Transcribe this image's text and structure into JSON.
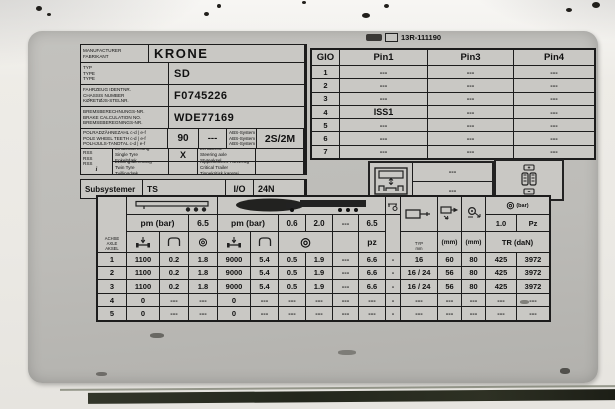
{
  "icons": {
    "brake_drum": "◎"
  },
  "plate": {
    "approval_number": "13R-111190",
    "info": {
      "manufacturer": {
        "labels": [
          "MANUFACTURER",
          "FABRIKANT"
        ],
        "value": "KRONE"
      },
      "type": {
        "labels": [
          "TYP",
          "TYPE",
          "TYPE"
        ],
        "value": "SD"
      },
      "chassis": {
        "labels": [
          "FAHRZEUG IDENTNR.",
          "CHASSIS NUMBER",
          "KØRETØJS-STELNR."
        ],
        "value": "F0745226"
      },
      "brake_calc": {
        "labels": [
          "BREMSBERECHNUNGS-NR.",
          "BRAKE CALCULATION NO.",
          "BREMSEBEREGNINGS-NR."
        ],
        "value": "WDE77169"
      },
      "pole_wheel": {
        "labels": [
          "POLRADZÄHNEZAHL c-d | e-f",
          "POLE WHEEL TEETH c-d | e-f",
          "POLHJULS-TANDTAL c-d | e-f"
        ],
        "teeth": "90",
        "teeth2": "---",
        "abs": [
          "ABS-System",
          "ABS-System",
          "ABS-System"
        ],
        "system": "2S/2M"
      },
      "rss": {
        "marks": [
          "RSS",
          "RSS",
          "RSS"
        ],
        "info_mark": "i",
        "single_tyre": {
          "labels": [
            "Einfachbereifung",
            "Single Tyre",
            "Enkeltdæk"
          ],
          "value": "X"
        },
        "steering_axle": {
          "labels": [
            "Lenkachse",
            "Steering axle",
            "Styreaksel"
          ],
          "value": ""
        },
        "twin_tyre": {
          "labels": [
            "Zwillingsbereifung",
            "Twin Tyre",
            "Tvillingdæk"
          ],
          "value": ""
        },
        "critical_trailer": {
          "labels": [
            "Kippkritisches Fahrzeug",
            "Critical Trailer",
            "Tippekritisk køretøj"
          ],
          "value": ""
        }
      },
      "subsystem": {
        "label": "Subsystemer",
        "value": "TS",
        "io_label": "I/O",
        "io_value": "24N"
      }
    },
    "gio": {
      "headers": [
        "GIO",
        "Pin1",
        "Pin3",
        "Pin4"
      ],
      "rows": [
        [
          "1",
          "---",
          "---",
          "---"
        ],
        [
          "2",
          "---",
          "---",
          "---"
        ],
        [
          "3",
          "---",
          "---",
          "---"
        ],
        [
          "4",
          "ISS1",
          "---",
          "---"
        ],
        [
          "5",
          "---",
          "---",
          "---"
        ],
        [
          "6",
          "---",
          "---",
          "---"
        ],
        [
          "7",
          "---",
          "---",
          "---"
        ]
      ]
    },
    "aux": {
      "values": [
        "---",
        "---"
      ]
    },
    "brake_table": {
      "axle_header": [
        "ACHSE",
        "AXLE",
        "AKSEL"
      ],
      "unladen": {
        "pm_label": "pm (bar)",
        "limit": "6.5"
      },
      "laden": {
        "pm_label": "pm (bar)",
        "p1": "0.6",
        "p2": "2.0",
        "p3": "---",
        "p4": "6.5",
        "pz": "pz"
      },
      "cylinder": {
        "typ": [
          "TYP",
          "mm"
        ],
        "mm1": "(mm)",
        "mm2": "(mm)"
      },
      "retention": {
        "bar_label": "(bar)",
        "p": "1.0",
        "pz": "Pz",
        "tr": "TR (daN)"
      },
      "rows": [
        [
          "1",
          "1100",
          "0.2",
          "1.8",
          "9000",
          "5.4",
          "0.5",
          "1.9",
          "---",
          "6.6",
          "-",
          "16",
          "60",
          "80",
          "425",
          "3972"
        ],
        [
          "2",
          "1100",
          "0.2",
          "1.8",
          "9000",
          "5.4",
          "0.5",
          "1.9",
          "---",
          "6.6",
          "-",
          "16 / 24",
          "56",
          "80",
          "425",
          "3972"
        ],
        [
          "3",
          "1100",
          "0.2",
          "1.8",
          "9000",
          "5.4",
          "0.5",
          "1.9",
          "---",
          "6.6",
          "-",
          "16 / 24",
          "56",
          "80",
          "425",
          "3972"
        ],
        [
          "4",
          "0",
          "---",
          "---",
          "0",
          "---",
          "---",
          "---",
          "---",
          "---",
          "-",
          "---",
          "---",
          "---",
          "---",
          "---"
        ],
        [
          "5",
          "0",
          "---",
          "---",
          "0",
          "---",
          "---",
          "---",
          "---",
          "---",
          "-",
          "---",
          "---",
          "---",
          "---",
          "---"
        ]
      ]
    }
  }
}
